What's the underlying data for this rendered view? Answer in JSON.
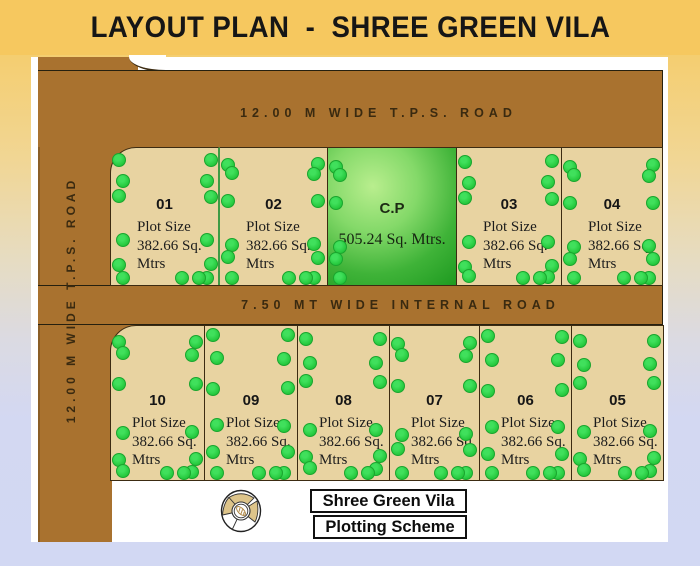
{
  "title": "LAYOUT PLAN  -  SHREE GREEN VILA",
  "roads": {
    "top_label": "12.00 M WIDE T.P.S. ROAD",
    "left_label": "12.00 M WIDE T.P.S. ROAD",
    "internal_label": "7.50 MT WIDE INTERNAL ROAD"
  },
  "plots": {
    "top_row": [
      {
        "type": "plot",
        "number": "01",
        "size_line1": "Plot Size",
        "size_line2": "382.66 Sq.",
        "size_line3": "Mtrs"
      },
      {
        "type": "plot",
        "number": "02",
        "size_line1": "Plot Size",
        "size_line2": "382.66 Sq.",
        "size_line3": "Mtrs"
      },
      {
        "type": "cp",
        "label": "C.P",
        "area": "505.24 Sq. Mtrs."
      },
      {
        "type": "plot",
        "number": "03",
        "size_line1": "Plot Size",
        "size_line2": "382.66 Sq.",
        "size_line3": "Mtrs"
      },
      {
        "type": "plot",
        "number": "04",
        "size_line1": "Plot Size",
        "size_line2": "382.66 Sq.",
        "size_line3": "Mtrs"
      }
    ],
    "bottom_row": [
      {
        "type": "plot",
        "number": "10",
        "size_line1": "Plot Size",
        "size_line2": "382.66 Sq.",
        "size_line3": "Mtrs"
      },
      {
        "type": "plot",
        "number": "09",
        "size_line1": "Plot Size",
        "size_line2": "382.66 Sq.",
        "size_line3": "Mtrs"
      },
      {
        "type": "plot",
        "number": "08",
        "size_line1": "Plot Size",
        "size_line2": "382.66 Sq.",
        "size_line3": "Mtrs"
      },
      {
        "type": "plot",
        "number": "07",
        "size_line1": "Plot Size",
        "size_line2": "382.66 Sq.",
        "size_line3": "Mtrs"
      },
      {
        "type": "plot",
        "number": "06",
        "size_line1": "Plot Size",
        "size_line2": "382.66 Sq.",
        "size_line3": "Mtrs"
      },
      {
        "type": "plot",
        "number": "05",
        "size_line1": "Plot Size",
        "size_line2": "382.66 Sq.",
        "size_line3": "Mtrs"
      }
    ]
  },
  "footer": {
    "box1": "Shree Green Vila",
    "box2": "Plotting Scheme",
    "compass_icon": "compass-rose-icon"
  },
  "colors": {
    "banner_bg": "#F6C85F",
    "road_brown": "#A9722F",
    "plot_tan": "#E8D3A1",
    "tree_green": "#23C63A",
    "cp_green_light": "#B9EE8E",
    "cp_green_dark": "#1E9A20",
    "bg_top": "#F5CC69",
    "bg_bottom": "#D2D8F3",
    "outline": "#3C2B12"
  }
}
